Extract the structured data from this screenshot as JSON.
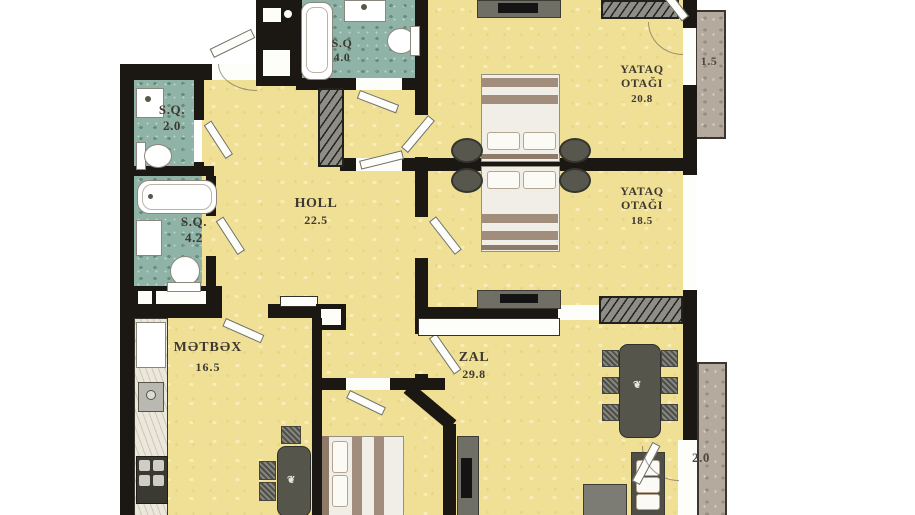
{
  "title": "Apartment floor plan",
  "rooms": {
    "sq40": {
      "name": "S.Q",
      "area": "4.0"
    },
    "sq20": {
      "name": "S.Q.",
      "area": "2.0"
    },
    "sq42": {
      "name": "S.Q.",
      "area": "4.2"
    },
    "holl": {
      "name": "HOLL",
      "area": "22.5"
    },
    "bedroom_top": {
      "name_line1": "YATAQ",
      "name_line2": "OTAĞI",
      "area": "20.8"
    },
    "bedroom_mid": {
      "name_line1": "YATAQ",
      "name_line2": "OTAĞI",
      "area": "18.5"
    },
    "kitchen": {
      "name": "MƏTBƏX",
      "area": "16.5"
    },
    "zal": {
      "name": "ZAL",
      "area": "29.8"
    }
  },
  "balconies": {
    "top": {
      "area": "1.5"
    },
    "bottom": {
      "area": "2.0"
    }
  },
  "colors": {
    "wall": "#1b1713",
    "floor_yellow": "#f0e096",
    "bath_floor_teal": "#8fb3a6",
    "balcony_stone": "#b4aa9e",
    "label_text": "#3e382f"
  }
}
